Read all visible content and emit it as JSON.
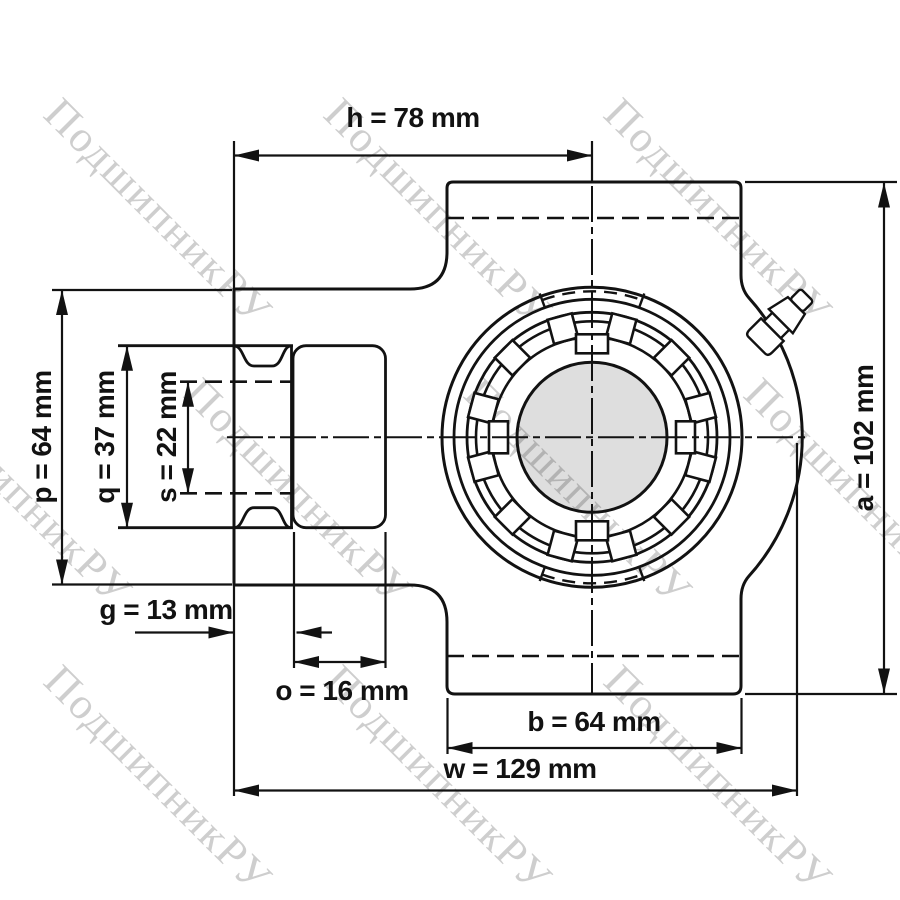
{
  "watermark": {
    "text": "ПодшипникРУ"
  },
  "drawing": {
    "units": "mm"
  },
  "dimensions": {
    "h": {
      "label": "h = 78 mm",
      "value": 78,
      "unit": "mm"
    },
    "p": {
      "label": "p = 64 mm",
      "value": 64,
      "unit": "mm"
    },
    "q": {
      "label": "q = 37 mm",
      "value": 37,
      "unit": "mm"
    },
    "s": {
      "label": "s = 22 mm",
      "value": 22,
      "unit": "mm"
    },
    "g": {
      "label": "g = 13 mm",
      "value": 13,
      "unit": "mm"
    },
    "o": {
      "label": "o = 16 mm",
      "value": 16,
      "unit": "mm"
    },
    "b": {
      "label": "b = 64 mm",
      "value": 64,
      "unit": "mm"
    },
    "w": {
      "label": "w = 129 mm",
      "value": 129,
      "unit": "mm"
    },
    "a": {
      "label": "a = 102 mm",
      "value": 102,
      "unit": "mm"
    }
  },
  "colors": {
    "line": "#121212",
    "shaft_fill": "rgba(0,0,0,0.13)",
    "watermark": "#c6c6c6",
    "background": "#ffffff"
  }
}
